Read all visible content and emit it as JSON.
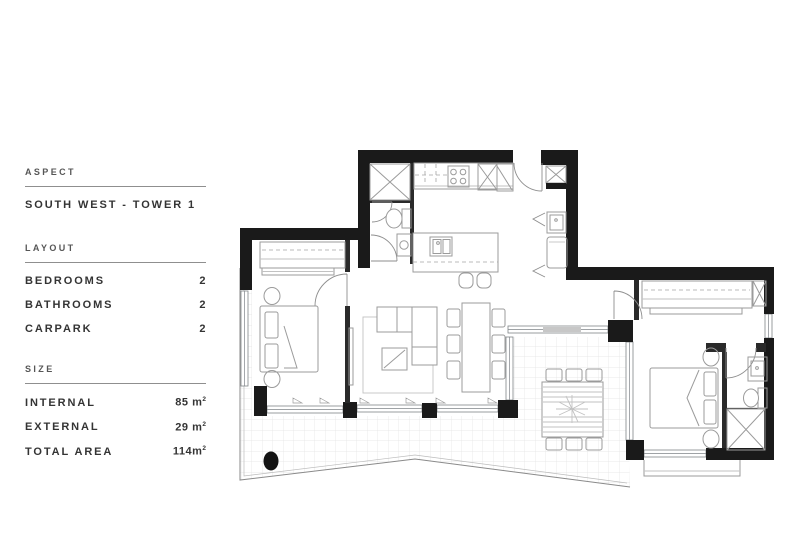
{
  "info_panel": {
    "aspect": {
      "heading": "ASPECT",
      "value": "SOUTH WEST - TOWER 1"
    },
    "layout": {
      "heading": "LAYOUT",
      "rows": [
        {
          "label": "BEDROOMS",
          "value": "2"
        },
        {
          "label": "BATHROOMS",
          "value": "2"
        },
        {
          "label": "CARPARK",
          "value": "2"
        }
      ]
    },
    "size": {
      "heading": "SIZE",
      "rows": [
        {
          "label": "INTERNAL",
          "value": "85 m",
          "sup": "2"
        },
        {
          "label": "EXTERNAL",
          "value": "29 m",
          "sup": "2"
        },
        {
          "label": "TOTAL AREA",
          "value": "114m",
          "sup": "2"
        }
      ]
    }
  },
  "floor_plan": {
    "type": "apartment-floor-plan-drawing",
    "wall_color": "#1a1a1a",
    "furniture_line_color": "#9b9b9b",
    "balcony_grid_color": "#e3e3e3"
  }
}
